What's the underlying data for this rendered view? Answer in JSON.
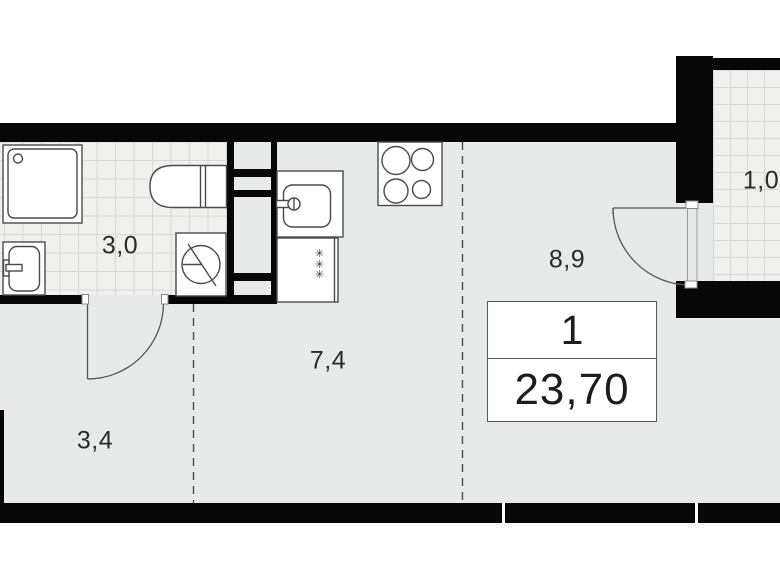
{
  "unit_card": {
    "rooms_count": "1",
    "total_area": "23,70"
  },
  "rooms": [
    {
      "id": "bathroom",
      "area_label": "3,0"
    },
    {
      "id": "hallway",
      "area_label": "3,4"
    },
    {
      "id": "kitchen",
      "area_label": "7,4"
    },
    {
      "id": "living-room",
      "area_label": "8,9"
    },
    {
      "id": "balcony",
      "area_label": "1,0"
    }
  ],
  "symbols": {
    "appliance_mark": "✳"
  },
  "colors": {
    "wall": "#070707",
    "floor": "#e8eaea",
    "tile_background": "#f0f1ef",
    "tile_line": "#d7d9d7",
    "fixture_stroke": "#4a4a4a",
    "label_text": "#2a2a2a"
  }
}
